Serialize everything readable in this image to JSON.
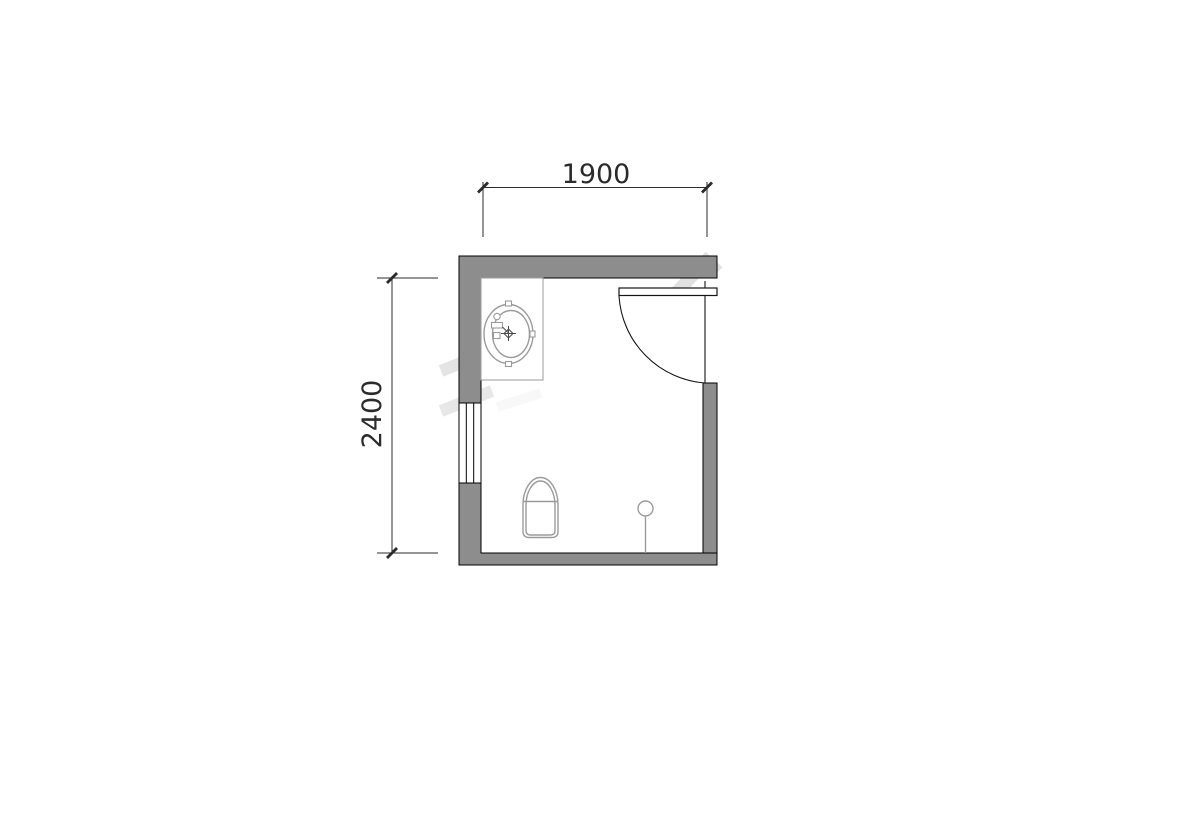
{
  "page": {
    "title": "Bathroom floor plan drawing"
  },
  "dimensions": {
    "top_label": "1900",
    "left_label": "2400"
  },
  "colors": {
    "background": "#ffffff",
    "wall_fill": "#8d8d8d",
    "wall_outline": "#000000",
    "fixture_line": "#9b9b9b",
    "fixture_detail": "#4a4a4a",
    "door_line": "#141414",
    "dim_line": "#2b2b2b",
    "dim_text": "#2b2b2b",
    "watermark": "#c9c9c9"
  },
  "fixtures": [
    {
      "name": "vanity-counter-with-oval-sink"
    },
    {
      "name": "hinged-door-with-swing-arc"
    },
    {
      "name": "window-in-left-wall"
    },
    {
      "name": "squat-toilet"
    },
    {
      "name": "floor-drain-with-pipe-line"
    }
  ]
}
